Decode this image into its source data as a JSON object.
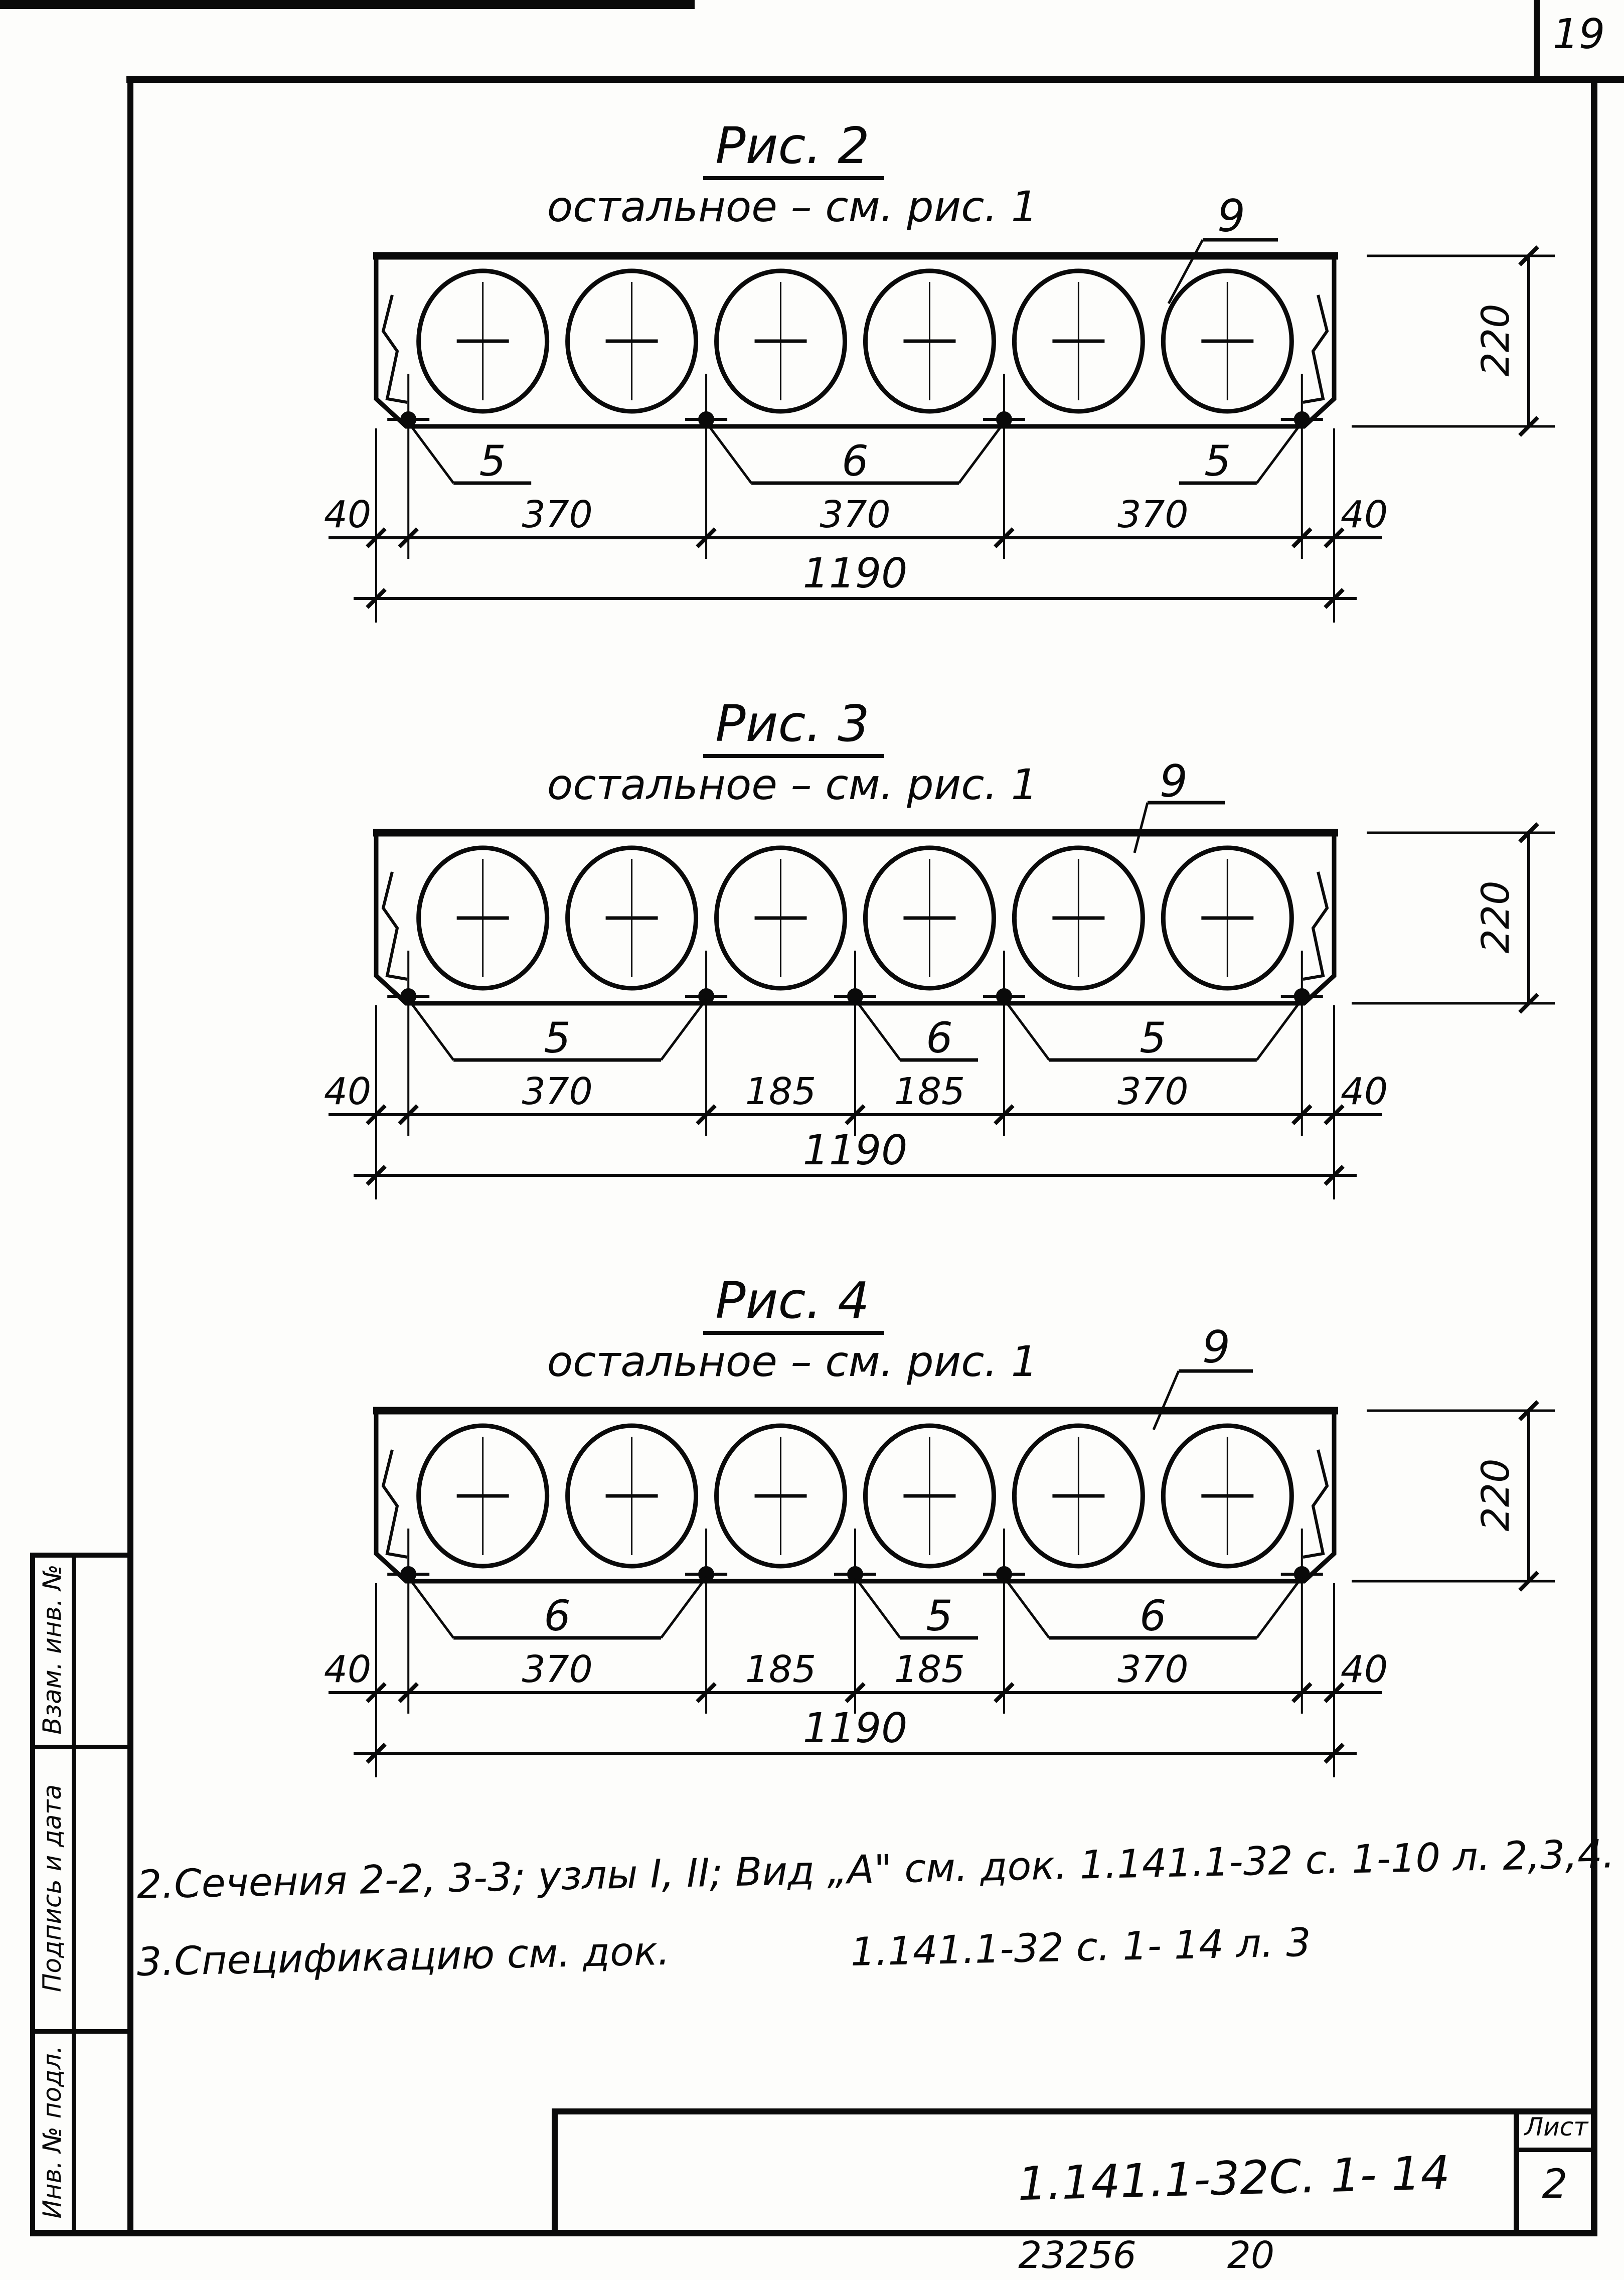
{
  "page": {
    "sheet_number_top": "19",
    "footer_code": "23256",
    "footer_page": "20"
  },
  "stamp_column": {
    "labels": [
      "Взам. инв. №",
      "Подпись и дата",
      "Инв. № подл."
    ]
  },
  "figures": [
    {
      "title": "Рис. 2",
      "subtitle": "остальное – см. рис. 1",
      "item": "9",
      "callouts": [
        {
          "label": "5",
          "dots": [
            0
          ]
        },
        {
          "label": "6",
          "dots": [
            1,
            2
          ]
        },
        {
          "label": "5",
          "dots": [
            3
          ]
        }
      ],
      "segments": [
        40,
        370,
        370,
        370,
        40
      ],
      "segment_labels": [
        "40",
        "370",
        "370",
        "370",
        "40"
      ],
      "total": "1190",
      "height": "220",
      "holes": 6
    },
    {
      "title": "Рис. 3",
      "subtitle": "остальное – см. рис. 1",
      "item": "9",
      "callouts": [
        {
          "label": "5",
          "dots": [
            0,
            1
          ]
        },
        {
          "label": "6",
          "dots": [
            2
          ]
        },
        {
          "label": "5",
          "dots": [
            3,
            4
          ]
        }
      ],
      "segments": [
        40,
        370,
        185,
        185,
        370,
        40
      ],
      "segment_labels": [
        "40",
        "370",
        "185",
        "185",
        "370",
        "40"
      ],
      "total": "1190",
      "height": "220",
      "holes": 6
    },
    {
      "title": "Рис. 4",
      "subtitle": "остальное – см. рис. 1",
      "item": "9",
      "callouts": [
        {
          "label": "6",
          "dots": [
            0,
            1
          ]
        },
        {
          "label": "5",
          "dots": [
            2
          ]
        },
        {
          "label": "6",
          "dots": [
            3,
            4
          ]
        }
      ],
      "segments": [
        40,
        370,
        185,
        185,
        370,
        40
      ],
      "segment_labels": [
        "40",
        "370",
        "185",
        "185",
        "370",
        "40"
      ],
      "total": "1190",
      "height": "220",
      "holes": 6
    }
  ],
  "notes": {
    "line1": "2.Сечения 2-2, 3-3; узлы I, II; Вид „А\" см. док. 1.141.1-32 с. 1-10 л. 2,3,4.",
    "line2_left": "3.Спецификацию см. док.",
    "line2_right": "1.141.1-32 с. 1- 14 л. 3"
  },
  "title_block": {
    "doc_number": "1.141.1-32С. 1- 14",
    "sheet_label": "Лист",
    "sheet_value": "2"
  }
}
